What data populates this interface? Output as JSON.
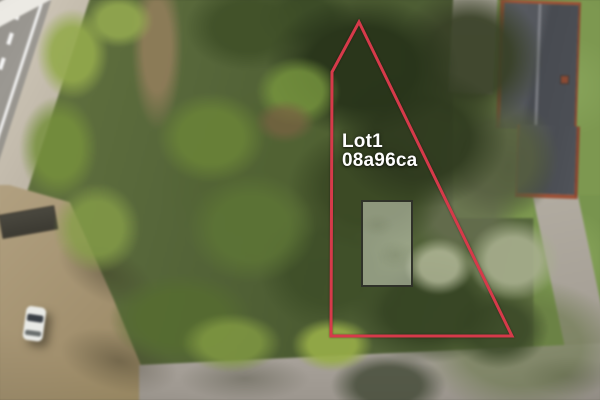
{
  "overlay": {
    "lot_name": "Lot1",
    "lot_code": "08a96ca",
    "boundary_points": "359,22 332,72 331,336 512,336",
    "boundary_color": "#d63a4a",
    "label_color": "#ffffff",
    "footprint": {
      "x": 361,
      "y": 200,
      "width": 52,
      "height": 87
    }
  },
  "scene": {
    "elements": [
      "wooded-lot-canopy",
      "asphalt-road-left",
      "sidewalk-path",
      "road-lane-markings",
      "dirt-parking-area",
      "white-car",
      "dark-shed",
      "bottom-road",
      "tree-shadows",
      "house-dark-roof-red-brick",
      "lawn",
      "gravel-driveway",
      "building-footprint-overlay",
      "lot-boundary-overlay",
      "lot-label"
    ]
  },
  "css": {
    "--boundary-color": "#d63a4a",
    "--label-color": "#ffffff",
    "--footprint-fill": "rgba(223,227,212,0.5)",
    "--footprint-border": "rgba(30,32,26,0.85)",
    "--fp-x": "361px",
    "--fp-y": "200px",
    "--fp-w": "52px",
    "--fp-h": "87px",
    "--label-x": "342px",
    "--label-y": "132px"
  }
}
